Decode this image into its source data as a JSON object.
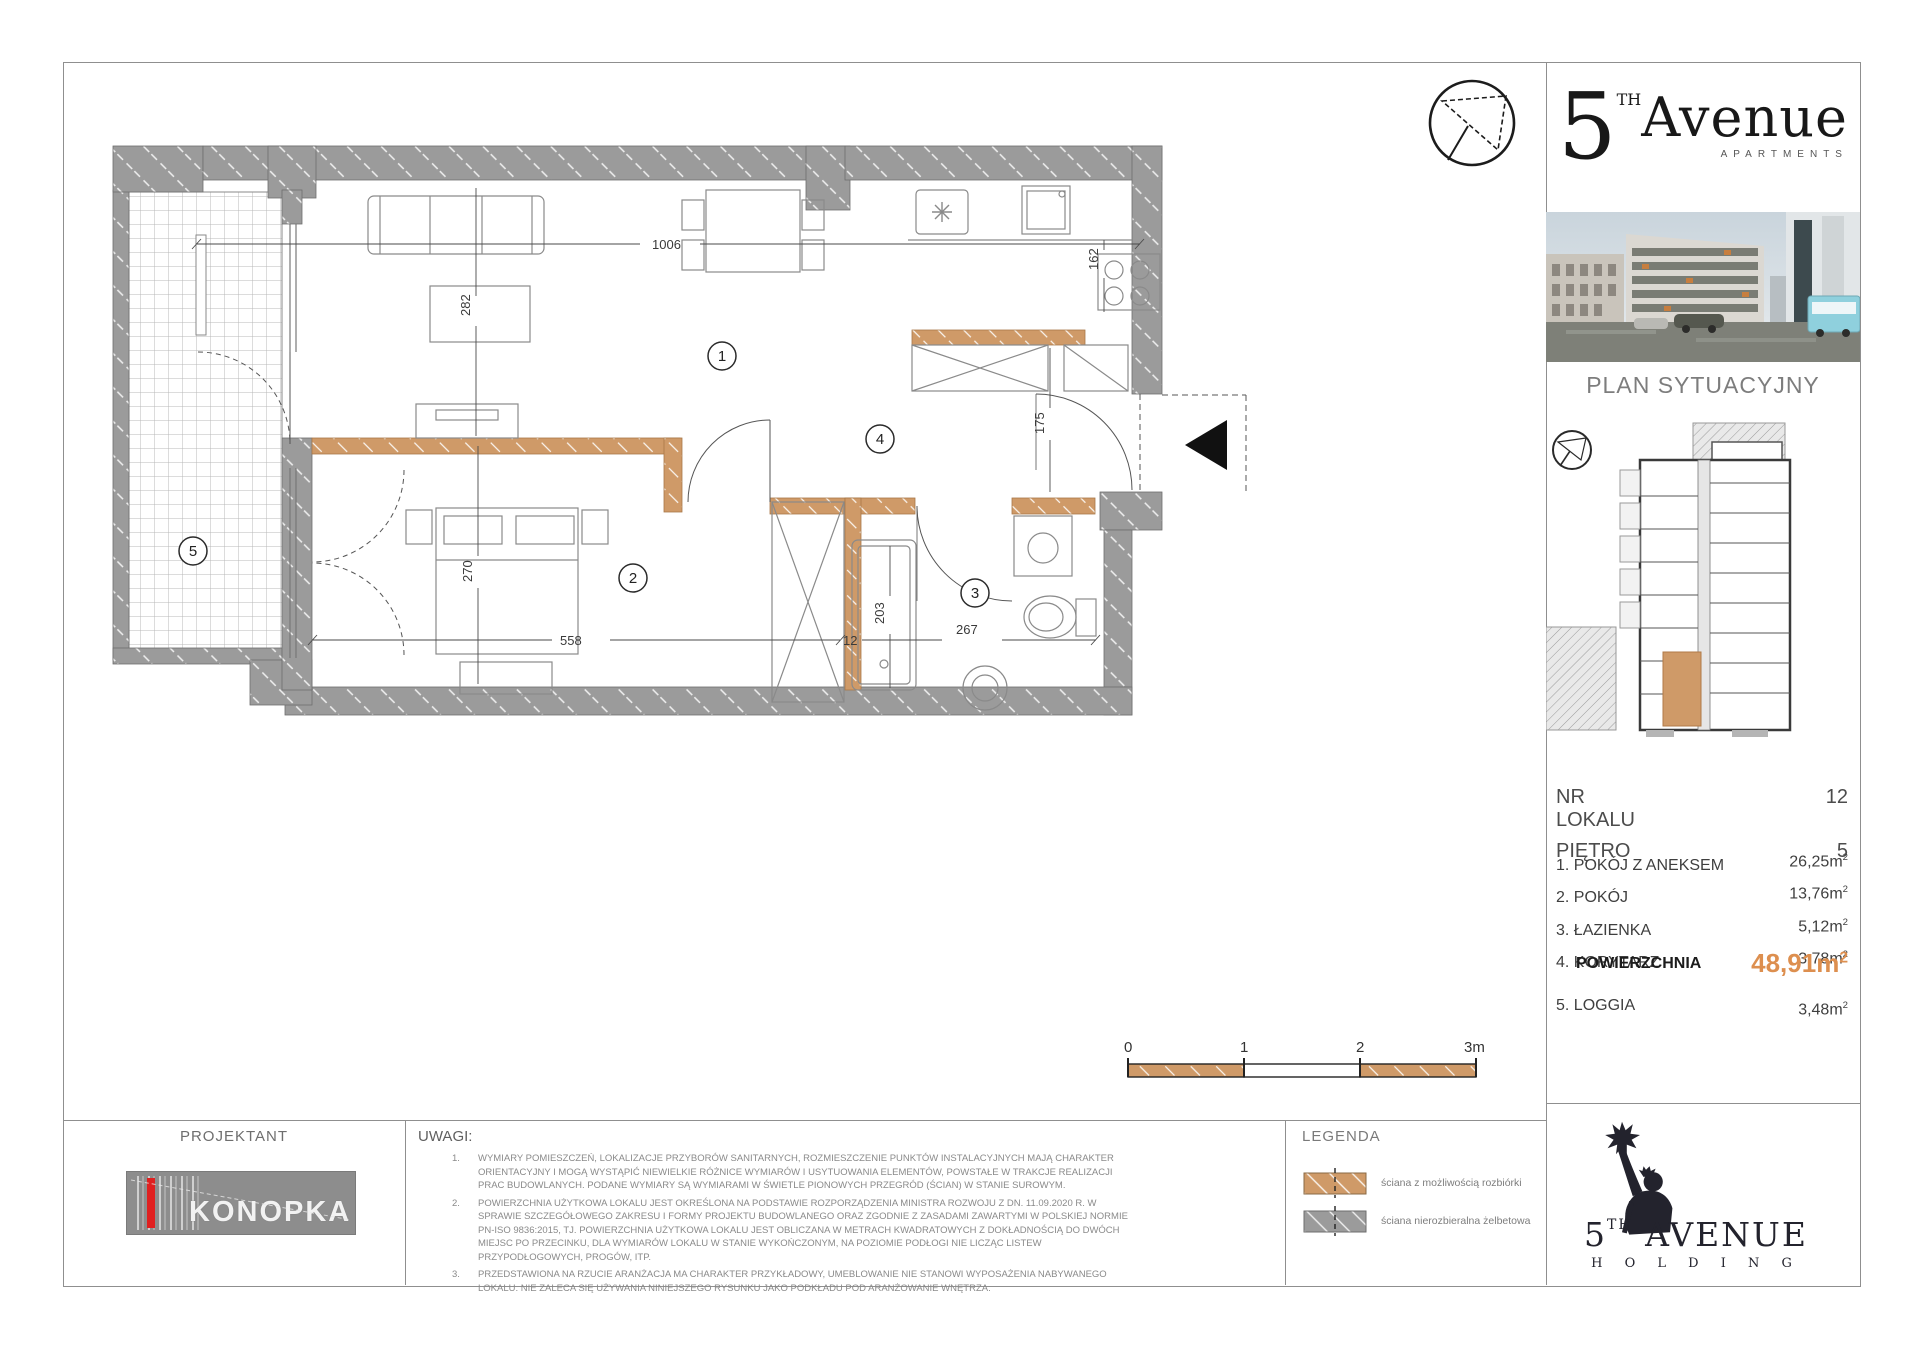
{
  "plan": {
    "dims": {
      "w_top": "1006",
      "h_living": "282",
      "w_kitchen": "162",
      "h_hall": "175",
      "h_room2": "270",
      "w_room2": "558",
      "w_wall": "12",
      "h_bath": "203",
      "w_bath": "267"
    },
    "rooms": {
      "r1": "1",
      "r2": "2",
      "r3": "3",
      "r4": "4",
      "r5": "5"
    }
  },
  "scalebar": {
    "t0": "0",
    "t1": "1",
    "t2": "2",
    "t3": "3m"
  },
  "panel": {
    "brand": {
      "five": "5",
      "th": "TH",
      "name": "Avenue",
      "sub": "APARTMENTS"
    },
    "section_title": "PLAN SYTUACYJNY",
    "unit_no_label": "NR LOKALU",
    "unit_no": "12",
    "floor_label": "PIĘTRO",
    "floor": "5",
    "rooms": [
      {
        "label": "1. POKÓJ Z ANEKSEM",
        "value": "26,25"
      },
      {
        "label": "2. POKÓJ",
        "value": "13,76"
      },
      {
        "label": "3. ŁAZIENKA",
        "value": "5,12"
      },
      {
        "label": "4. KORYTARZ",
        "value": "3,78"
      }
    ],
    "unit_suffix": "m",
    "unit_sup": "2",
    "total_label": "POWIERZCHNIA",
    "total_value": "48,91",
    "loggia_label": "5. LOGGIA",
    "loggia_value": "3,48"
  },
  "footer": {
    "projektant": "PROJEKTANT",
    "studio_line1": "PROART",
    "studio_line2": "KONOPKA",
    "uwagi_title": "UWAGI:",
    "notes": [
      {
        "num": "1.",
        "text": "WYMIARY POMIESZCZEŃ, LOKALIZACJE PRZYBORÓW SANITARNYCH, ROZMIESZCZENIE PUNKTÓW INSTALACYJNYCH MAJĄ CHARAKTER ORIENTACYJNY I MOGĄ WYSTĄPIĆ NIEWIELKIE RÓŻNICE WYMIARÓW I USYTUOWANIA ELEMENTÓW, POWSTAŁE W TRAKCJE REALIZACJI PRAC BUDOWLANYCH. PODANE WYMIARY SĄ WYMIARAMI W ŚWIETLE PIONOWYCH PRZEGRÓD (ŚCIAN) W STANIE SUROWYM."
      },
      {
        "num": "2.",
        "text": "POWIERZCHNIA UŻYTKOWA LOKALU JEST OKREŚLONA NA PODSTAWIE ROZPORZĄDZENIA MINISTRA ROZWOJU Z DN. 11.09.2020 R. W SPRAWIE SZCZEGÓŁOWEGO ZAKRESU I FORMY PROJEKTU BUDOWLANEGO ORAZ ZGODNIE Z ZASADAMI ZAWARTYMI W POLSKIEJ NORMIE PN-ISO 9836:2015, TJ. POWIERZCHNIA UŻYTKOWA LOKALU JEST OBLICZANA W METRACH KWADRATOWYCH Z DOKŁADNOŚCIĄ DO DWÓCH MIEJSC PO PRZECINKU, DLA WYMIARÓW LOKALU W STANIE WYKOŃCZONYM, NA POZIOMIE PODŁOGI NIE LICZĄC LISTEW PRZYPODŁOGOWYCH, PROGÓW, ITP."
      },
      {
        "num": "3.",
        "text": "PRZEDSTAWIONA NA RZUCIE ARANŻACJA MA CHARAKTER PRZYKŁADOWY, UMEBLOWANIE NIE STANOWI WYPOSAŻENIA NABYWANEGO LOKALU. NIE ZALECA SIĘ UŻYWANIA NINIEJSZEGO RYSUNKU JAKO PODKŁADU POD ARANŻOWANIE WNĘTRZA."
      }
    ],
    "legend_title": "LEGENDA",
    "legend": [
      {
        "label": "ściana z możliwością rozbiórki"
      },
      {
        "label": "ściana nierozbieralna żelbetowa"
      }
    ],
    "holding": {
      "five": "5",
      "th": "TH",
      "name": " AVENUE",
      "sub": "H O L D I N G"
    }
  },
  "colors": {
    "wall_orange": "#CF9A68",
    "wall_gray": "#9B9B9B",
    "area_value_orange": "#DD8F4F"
  }
}
